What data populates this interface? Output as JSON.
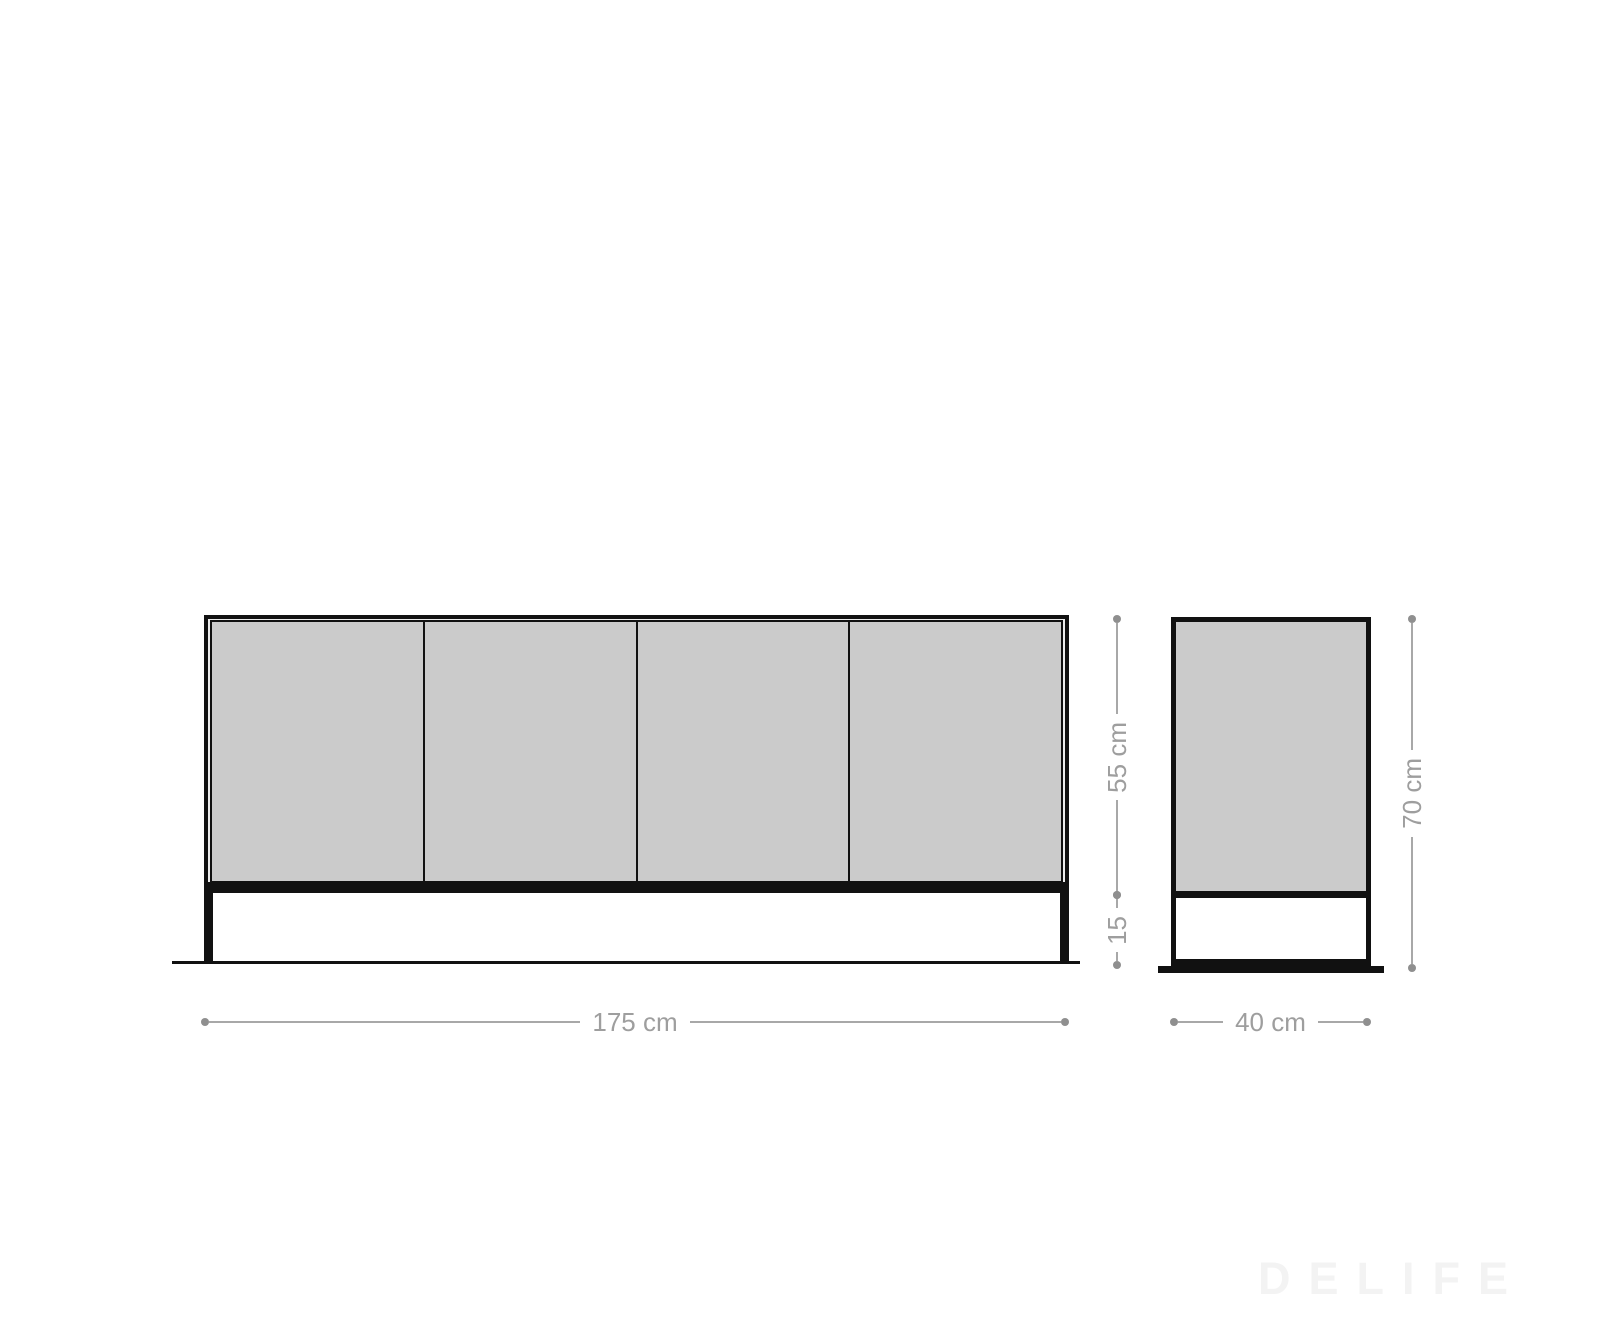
{
  "dimensions": {
    "front_width": "175 cm",
    "depth": "40 cm",
    "body_height": "55 cm",
    "leg_height": "15",
    "total_height": "70 cm"
  },
  "front_view": {
    "door_count": 4
  },
  "watermark": "DELIFE",
  "colors": {
    "outline": "#111111",
    "panel_fill": "#cbcbcb",
    "frame_margin": "#ececec",
    "dimension_gray": "#9e9e9e",
    "watermark_gray": "#f3f3f3",
    "background": "#ffffff"
  }
}
